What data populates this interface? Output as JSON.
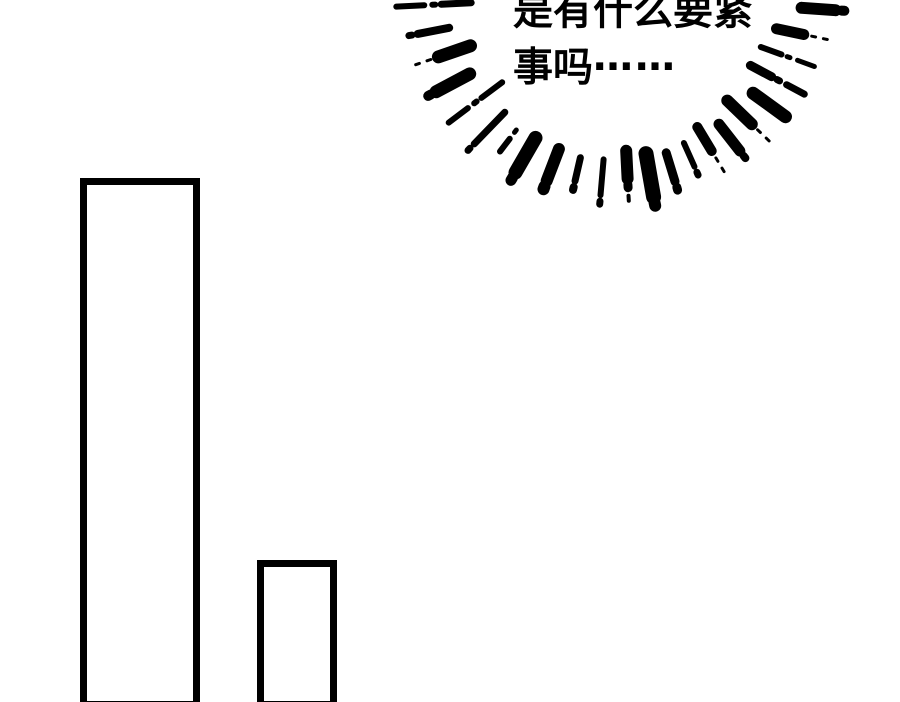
{
  "page": {
    "background_color": "#ffffff",
    "ink_color": "#000000"
  },
  "speech": {
    "line1": "是有什么要紧",
    "line2": "事吗",
    "ellipsis": "……"
  },
  "burst": {
    "cx": 618,
    "cy": -5,
    "color": "#000000",
    "dash_gap": 8,
    "dot_gap": 6,
    "marks": [
      {
        "a": 177,
        "r": 222,
        "s": [
          [
            28,
            6
          ],
          [
            3,
            6
          ],
          [
            30,
            7
          ]
        ]
      },
      {
        "a": 169,
        "r": 213,
        "s": [
          [
            3,
            7
          ],
          [
            32,
            8
          ]
        ]
      },
      {
        "a": 161,
        "r": 214,
        "s": [
          [
            4,
            3
          ],
          [
            4,
            3
          ],
          [
            34,
            13
          ]
        ]
      },
      {
        "a": 152,
        "r": 215,
        "s": [
          [
            3,
            10
          ],
          [
            38,
            13
          ]
        ]
      },
      {
        "a": 143,
        "r": 212,
        "s": [
          [
            24,
            6
          ],
          [
            3,
            6
          ],
          [
            26,
            6
          ]
        ]
      },
      {
        "a": 134,
        "r": 216,
        "s": [
          [
            3,
            7
          ],
          [
            44,
            7
          ]
        ]
      },
      {
        "a": 127,
        "r": 196,
        "s": [
          [
            16,
            6
          ],
          [
            3,
            5
          ]
        ]
      },
      {
        "a": 120,
        "r": 214,
        "s": [
          [
            3,
            11
          ],
          [
            40,
            14
          ]
        ]
      },
      {
        "a": 111,
        "r": 208,
        "s": [
          [
            3,
            12
          ],
          [
            34,
            12
          ]
        ]
      },
      {
        "a": 103,
        "r": 200,
        "s": [
          [
            3,
            8
          ],
          [
            24,
            7
          ]
        ]
      },
      {
        "a": 95,
        "r": 210,
        "s": [
          [
            3,
            7
          ],
          [
            36,
            6
          ]
        ]
      },
      {
        "a": 87,
        "r": 206,
        "s": [
          [
            5,
            4
          ],
          [
            3,
            9
          ],
          [
            28,
            12
          ]
        ]
      },
      {
        "a": 80,
        "r": 214,
        "s": [
          [
            3,
            12
          ],
          [
            44,
            15
          ]
        ]
      },
      {
        "a": 73,
        "r": 204,
        "s": [
          [
            3,
            9
          ],
          [
            30,
            9
          ]
        ]
      },
      {
        "a": 66,
        "r": 197,
        "s": [
          [
            3,
            7
          ],
          [
            26,
            6
          ]
        ]
      },
      {
        "a": 59,
        "r": 206,
        "s": [
          [
            4,
            3
          ],
          [
            4,
            3
          ],
          [
            28,
            10
          ]
        ]
      },
      {
        "a": 52,
        "r": 207,
        "s": [
          [
            3,
            8
          ],
          [
            34,
            11
          ]
        ]
      },
      {
        "a": 44,
        "r": 210,
        "s": [
          [
            4,
            3
          ],
          [
            4,
            3
          ],
          [
            34,
            12
          ]
        ]
      },
      {
        "a": 36,
        "r": 207,
        "s": [
          [
            40,
            13
          ]
        ]
      },
      {
        "a": 28,
        "r": 211,
        "s": [
          [
            20,
            7
          ],
          [
            3,
            7
          ],
          [
            24,
            9
          ]
        ]
      },
      {
        "a": 20,
        "r": 209,
        "s": [
          [
            18,
            5
          ],
          [
            3,
            5
          ],
          [
            22,
            6
          ]
        ]
      },
      {
        "a": 12,
        "r": 214,
        "s": [
          [
            4,
            3
          ],
          [
            4,
            3
          ],
          [
            28,
            11
          ]
        ]
      },
      {
        "a": 4,
        "r": 227,
        "s": [
          [
            3,
            10
          ],
          [
            34,
            12
          ]
        ]
      }
    ]
  },
  "shapes": {
    "panel_rects": [
      {
        "left": 80,
        "top": 178,
        "width": 120,
        "height": 530,
        "border": 7
      },
      {
        "left": 257,
        "top": 560,
        "width": 80,
        "height": 148,
        "border": 7
      }
    ]
  }
}
